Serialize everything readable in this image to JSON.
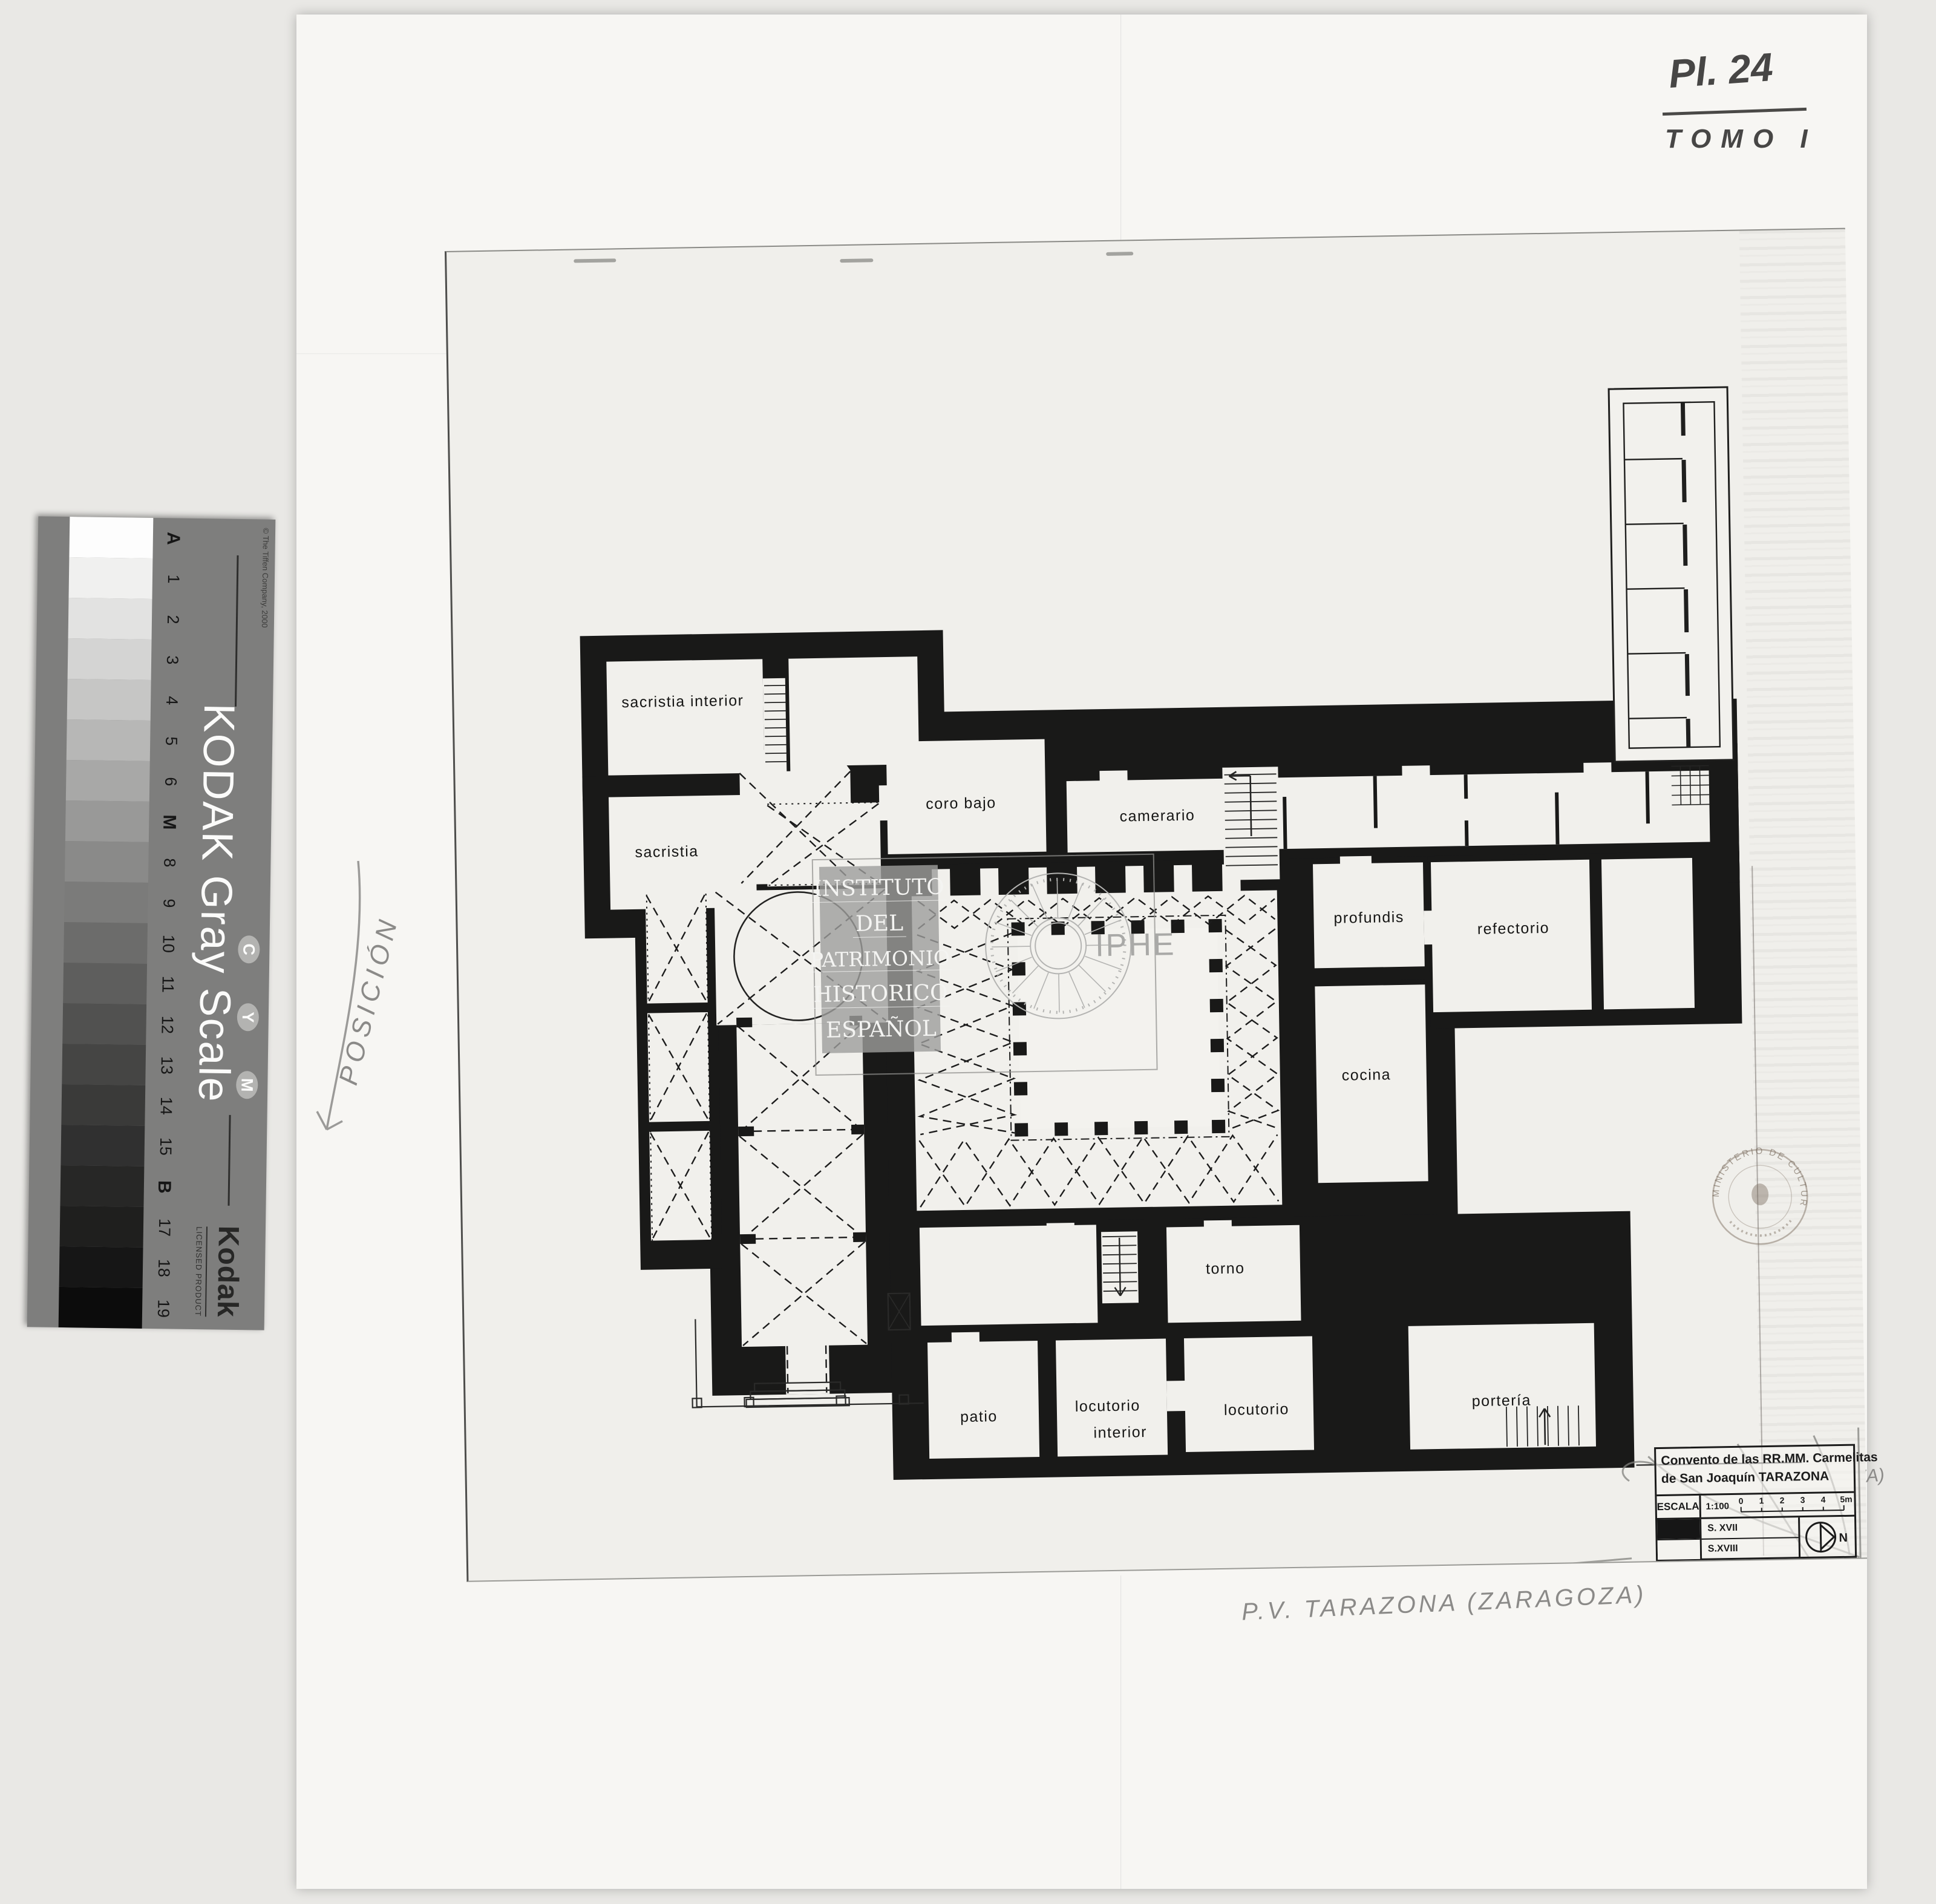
{
  "annotations": {
    "plate": "Pl. 24",
    "volume": "TOMO I",
    "reference": "A 1023",
    "margin_note": "POSICIÓN",
    "bottom_note": "P.V. TARAZONA (ZARAGOZA)",
    "title_addition": "(ZARAGOZA)"
  },
  "gray_scale_card": {
    "copyright": "© The Tiffen Company, 2000",
    "title": "KODAK Gray Scale",
    "brand": "Kodak",
    "licensed": "LICENSED PRODUCT",
    "cym": [
      "C",
      "Y",
      "M"
    ],
    "steps": [
      "A",
      "1",
      "2",
      "3",
      "4",
      "5",
      "6",
      "M",
      "8",
      "9",
      "10",
      "11",
      "12",
      "13",
      "14",
      "15",
      "B",
      "17",
      "18",
      "19"
    ],
    "patch_colors": [
      "#fdfdfd",
      "#f0f0ef",
      "#e2e2e1",
      "#d4d4d3",
      "#c6c6c5",
      "#b7b7b6",
      "#a8a8a7",
      "#999998",
      "#8a8a89",
      "#7b7b7a",
      "#6c6c6b",
      "#5e5e5d",
      "#515150",
      "#454544",
      "#3a3a39",
      "#303030",
      "#272726",
      "#1f1f1e",
      "#161616",
      "#0c0c0c"
    ]
  },
  "watermark": {
    "lines": [
      "INSTITUTO",
      "DEL",
      "PATRIMONIO",
      "HISTORICO",
      "ESPAÑOL"
    ],
    "acronym": "IPHE"
  },
  "stamp": {
    "text": "MINISTERIO DE CULTURA"
  },
  "title_block": {
    "title_line1": "Convento de las RR.MM. Carmelitas",
    "title_line2": "de San Joaquín TARAZONA",
    "escala_label": "ESCALA",
    "scale_ratio": "1:100",
    "scale_ticks": [
      "0",
      "1",
      "2",
      "3",
      "4",
      "5m"
    ],
    "legend": [
      {
        "label": "S. XVII"
      },
      {
        "label": "S.XVIII"
      }
    ],
    "north_label": "N"
  },
  "plan": {
    "rooms": [
      {
        "id": "sacristia-interior",
        "label": "sacristia interior"
      },
      {
        "id": "sacristia",
        "label": "sacristia"
      },
      {
        "id": "coro-bajo",
        "label": "coro  bajo"
      },
      {
        "id": "camerario",
        "label": "camerario"
      },
      {
        "id": "profundis",
        "label": "profundis"
      },
      {
        "id": "refectorio",
        "label": "refectorio"
      },
      {
        "id": "cocina",
        "label": "cocina"
      },
      {
        "id": "torno",
        "label": "torno"
      },
      {
        "id": "patio",
        "label": "patio"
      },
      {
        "id": "locutorio-interior",
        "label": "locutorio",
        "label2": "interior"
      },
      {
        "id": "locutorio",
        "label": "locutorio"
      },
      {
        "id": "porteria",
        "label": "portería"
      }
    ]
  }
}
